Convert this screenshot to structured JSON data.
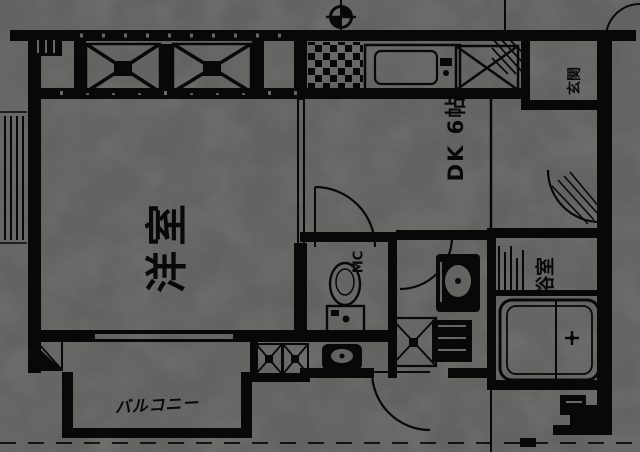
{
  "document": {
    "kind": "scanned floor plan (rotated 90°)",
    "paper_color": "#f7f7f4",
    "ink_color": "#161616"
  },
  "plan": {
    "labels": {
      "living_room": "洋室",
      "dining_kitchen": "DK 6帖",
      "bathroom": "浴室",
      "entrance": "玄関",
      "meter_box": "MC",
      "balcony_note": "バルコニー"
    },
    "fixtures": [
      "gas-meter",
      "kitchen-sink",
      "stove-tile-grid",
      "refrigerator-x-space",
      "balcony-x-brace-panels",
      "toilet",
      "hand-wash-basin",
      "vanity-basin",
      "washing-machine-pan",
      "bathtub",
      "shower-grate",
      "storage-x-boxes",
      "door-swing-arcs",
      "handwritten-balcony-box"
    ]
  }
}
